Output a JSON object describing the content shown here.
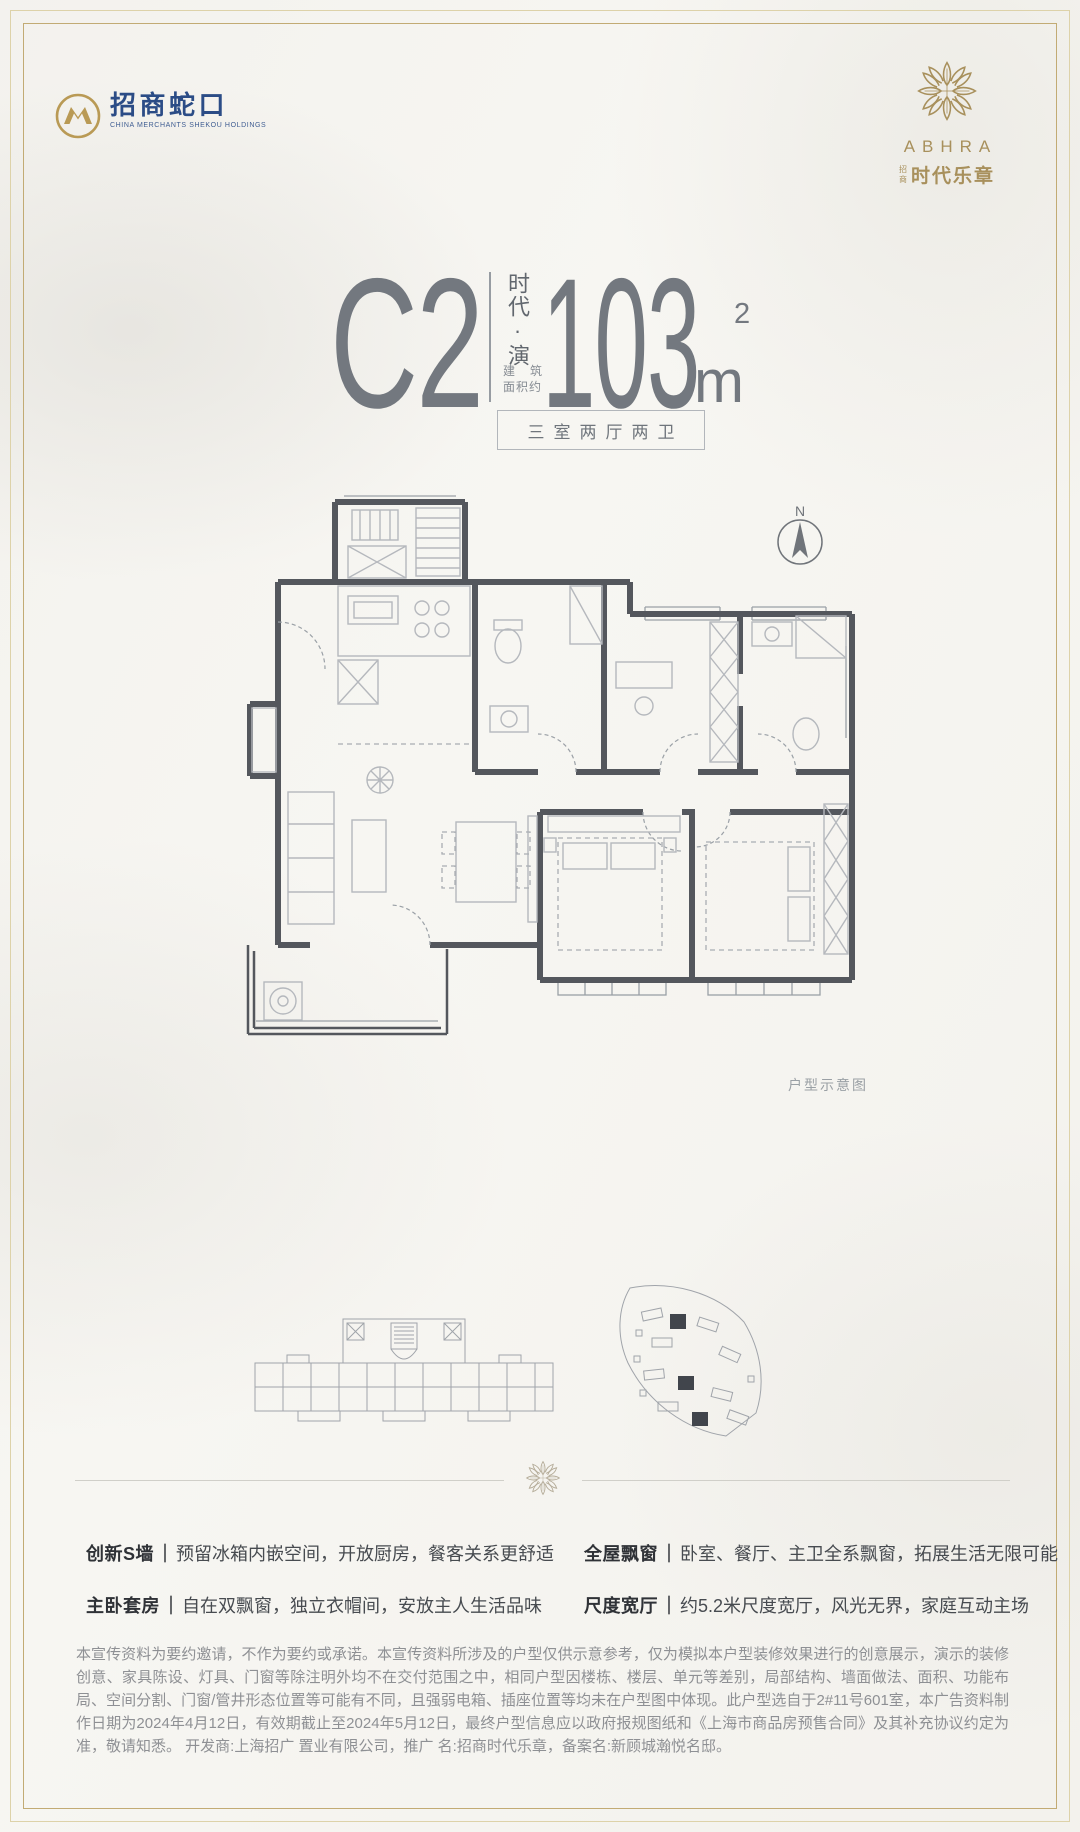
{
  "page": {
    "background": "#f7f6f2",
    "frame_gold": "#c2ab74",
    "frame_gold_light": "#ddd2a9"
  },
  "header": {
    "developer_logo": {
      "name_cn": "招商蛇口",
      "name_en": "CHINA MERCHANTS SHEKOU HOLDINGS",
      "brand_blue": "#2b4c86",
      "brand_gold": "#b99a55"
    },
    "project_logo": {
      "brand": "ABHRA",
      "prefix_small": "招商",
      "name_cn": "时代乐章",
      "gold": "#a8905c"
    }
  },
  "title_block": {
    "unit_code": "C2",
    "series_name_vertical": "时代·演",
    "area_label_char1": "建",
    "area_label_char2": "筑",
    "area_label_line2": "面积约",
    "area_number": "103",
    "area_unit": "m",
    "area_superscript": "2",
    "rooms_label": "三室两厅两卫"
  },
  "floor_plan": {
    "north_label": "N",
    "caption": "户型示意图"
  },
  "features": {
    "separator": "｜",
    "items": [
      {
        "label": "创新S墙",
        "text": "预留冰箱内嵌空间，开放厨房，餐客关系更舒适"
      },
      {
        "label": "主卧套房",
        "text": "自在双飘窗，独立衣帽间，安放主人生活品味"
      },
      {
        "label": "全屋飘窗",
        "text": "卧室、餐厅、主卫全系飘窗，拓展生活无限可能"
      },
      {
        "label": "尺度宽厅",
        "text": "约5.2米尺度宽厅，风光无界，家庭互动主场"
      }
    ]
  },
  "disclaimer": "本宣传资料为要约邀请，不作为要约或承诺。本宣传资料所涉及的户型仅供示意参考，仅为模拟本户型装修效果进行的创意展示，演示的装修创意、家具陈设、灯具、门窗等除注明外均不在交付范围之中，相同户型因楼栋、楼层、单元等差别，局部结构、墙面做法、面积、功能布局、空间分割、门窗/管井形态位置等可能有不同，且强弱电箱、插座位置等均未在户型图中体现。此户型选自于2#11号601室，本广告资料制作日期为2024年4月12日，有效期截止至2024年5月12日，最终户型信息应以政府报规图纸和《上海市商品房预售合同》及其补充协议约定为准，敬请知悉。 开发商:上海招广 置业有限公司，推广 名:招商时代乐章，备案名:新顾城瀚悦名邸。"
}
